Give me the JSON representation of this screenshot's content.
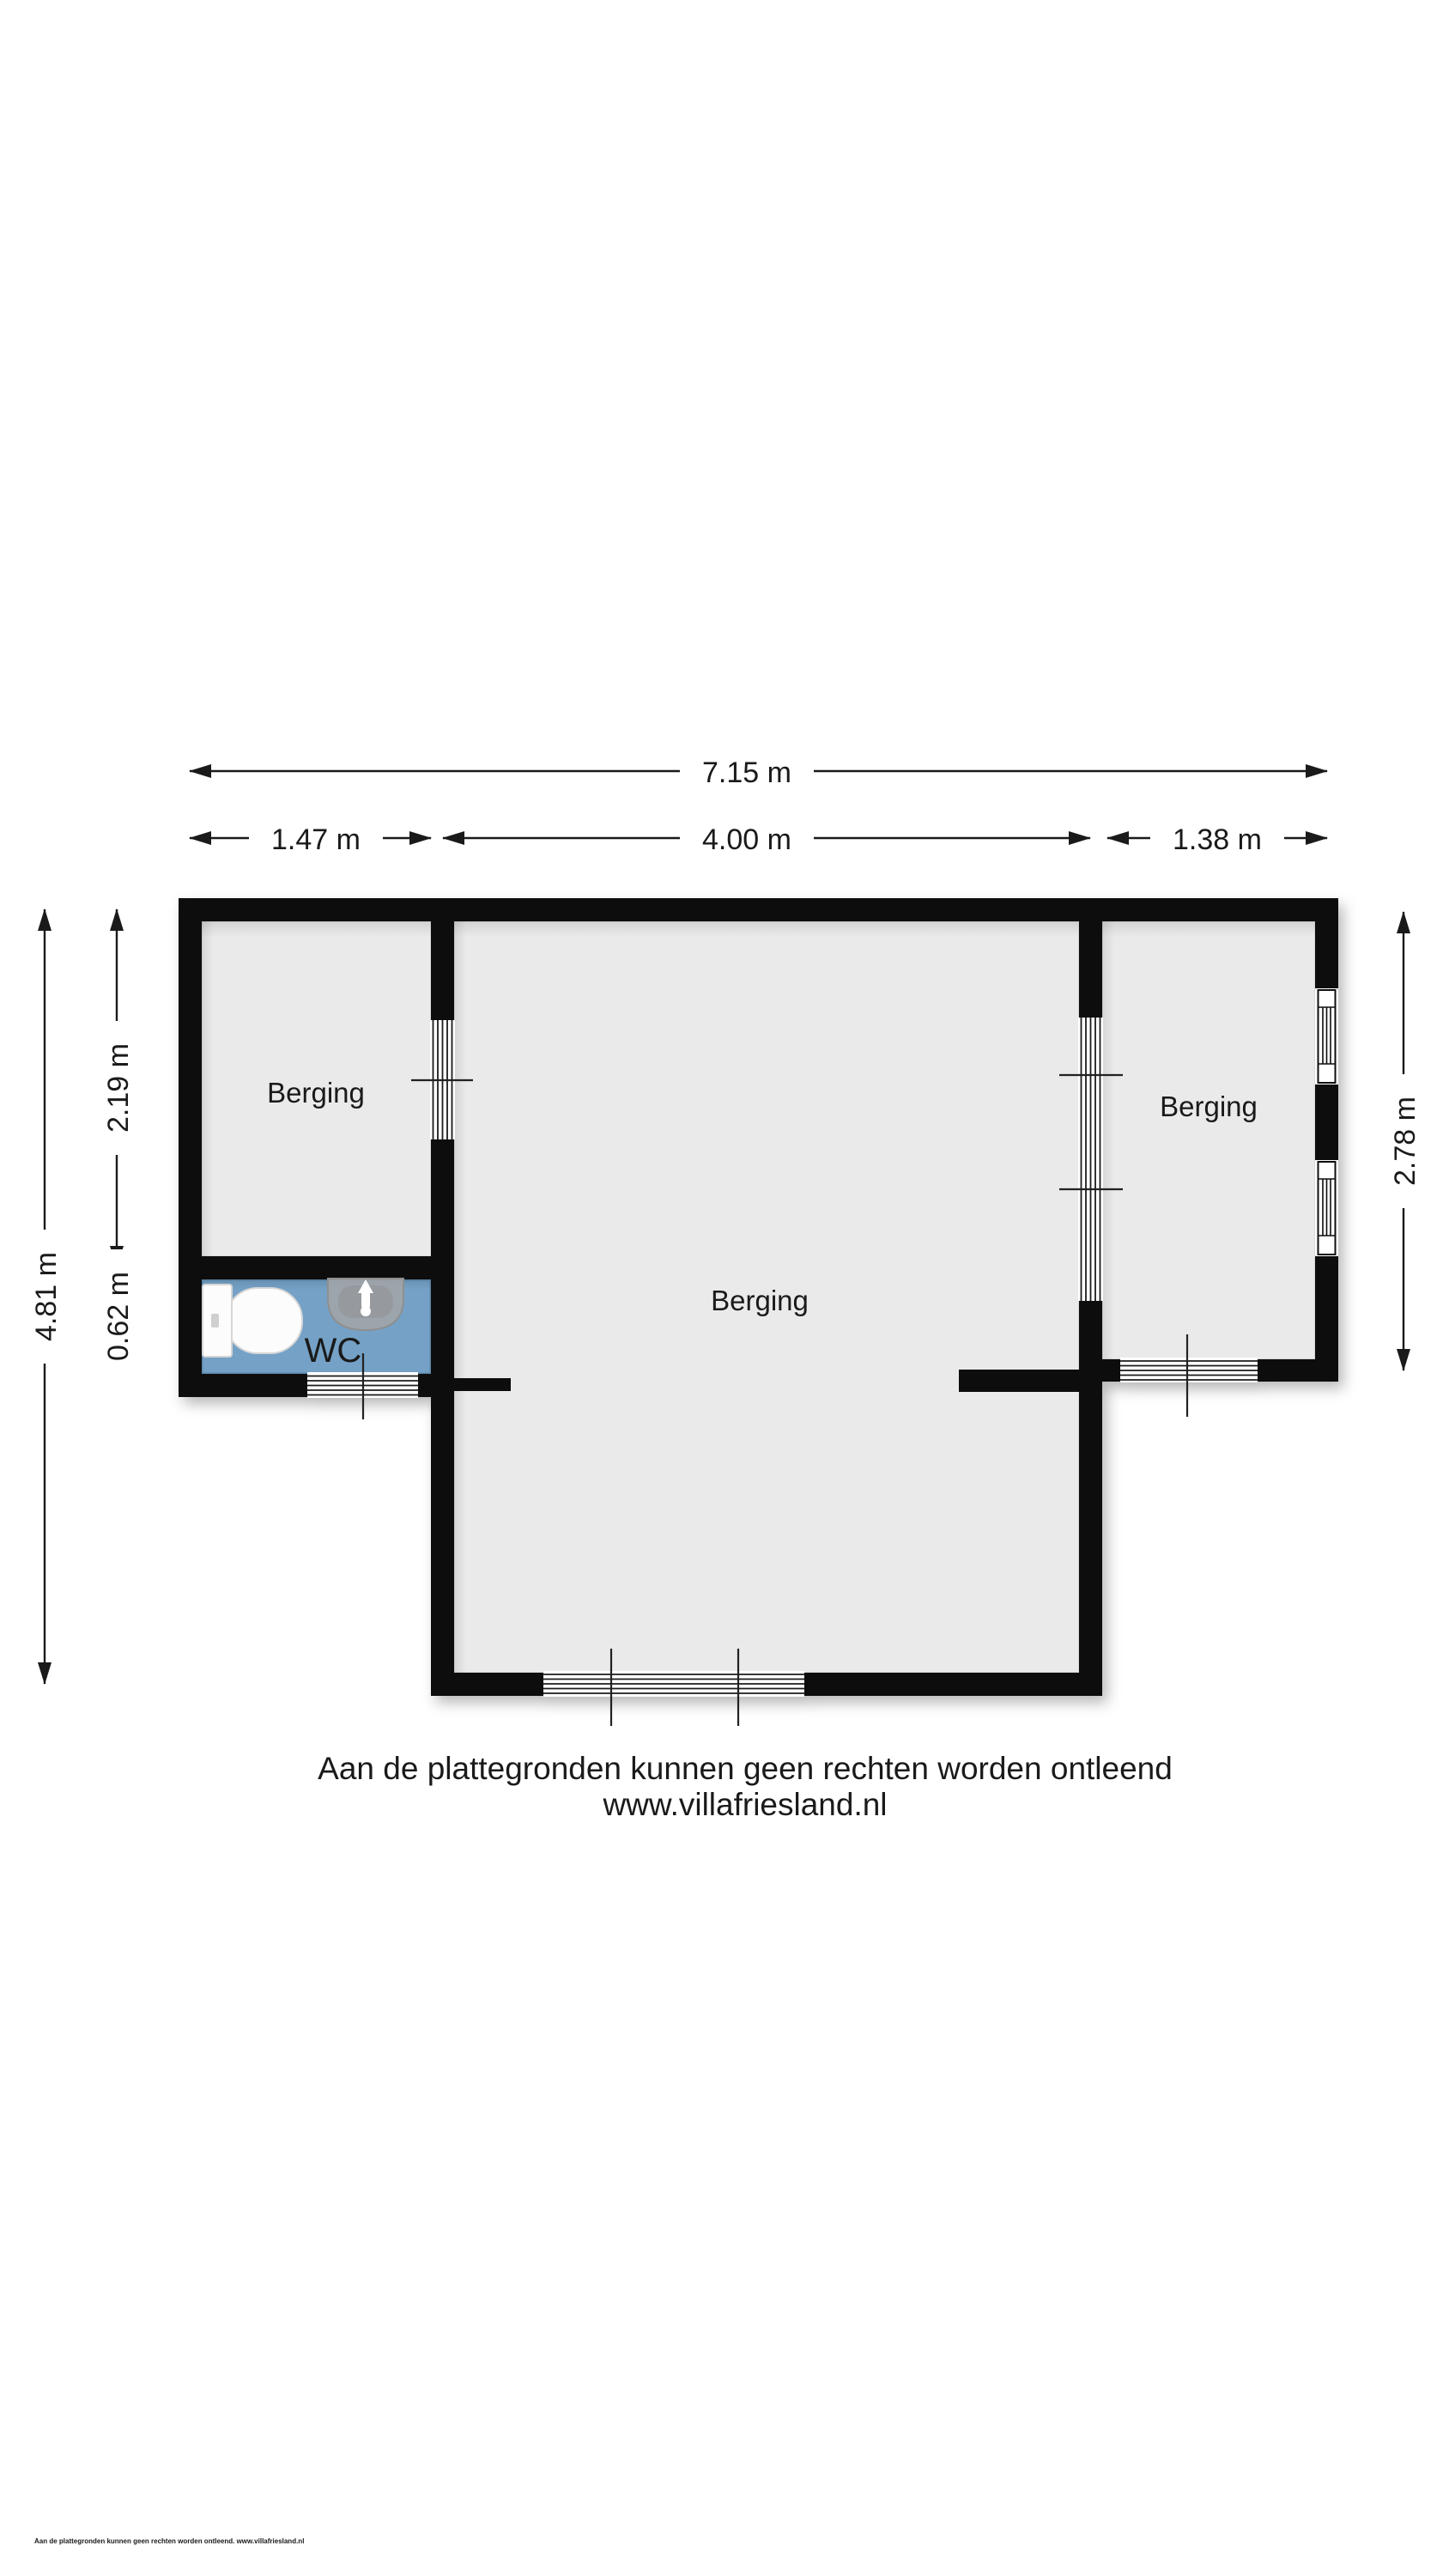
{
  "plan": {
    "rooms": [
      {
        "label": "Berging"
      },
      {
        "label": "Berging"
      },
      {
        "label": "Berging"
      },
      {
        "label": "WC"
      }
    ],
    "dimensions": {
      "total_width": "7.15 m",
      "left_width": "1.47 m",
      "center_width": "4.00 m",
      "right_width": "1.38 m",
      "overall_height": "4.81 m",
      "berging_left_height": "2.19 m",
      "wc_height": "0.62 m",
      "berging_right_height": "2.78 m"
    },
    "colors": {
      "wall": "#0a0a0a",
      "floor": "#eaeaea",
      "wc_floor": "#74a1c6",
      "dimension_line": "#1a1a1a"
    }
  },
  "footer": {
    "disclaimer": "Aan de plattegronden kunnen geen rechten worden ontleend",
    "website": "www.villafriesland.nl",
    "fine_print": "Aan de plattegronden kunnen geen rechten worden ontleend. www.villafriesland.nl"
  }
}
